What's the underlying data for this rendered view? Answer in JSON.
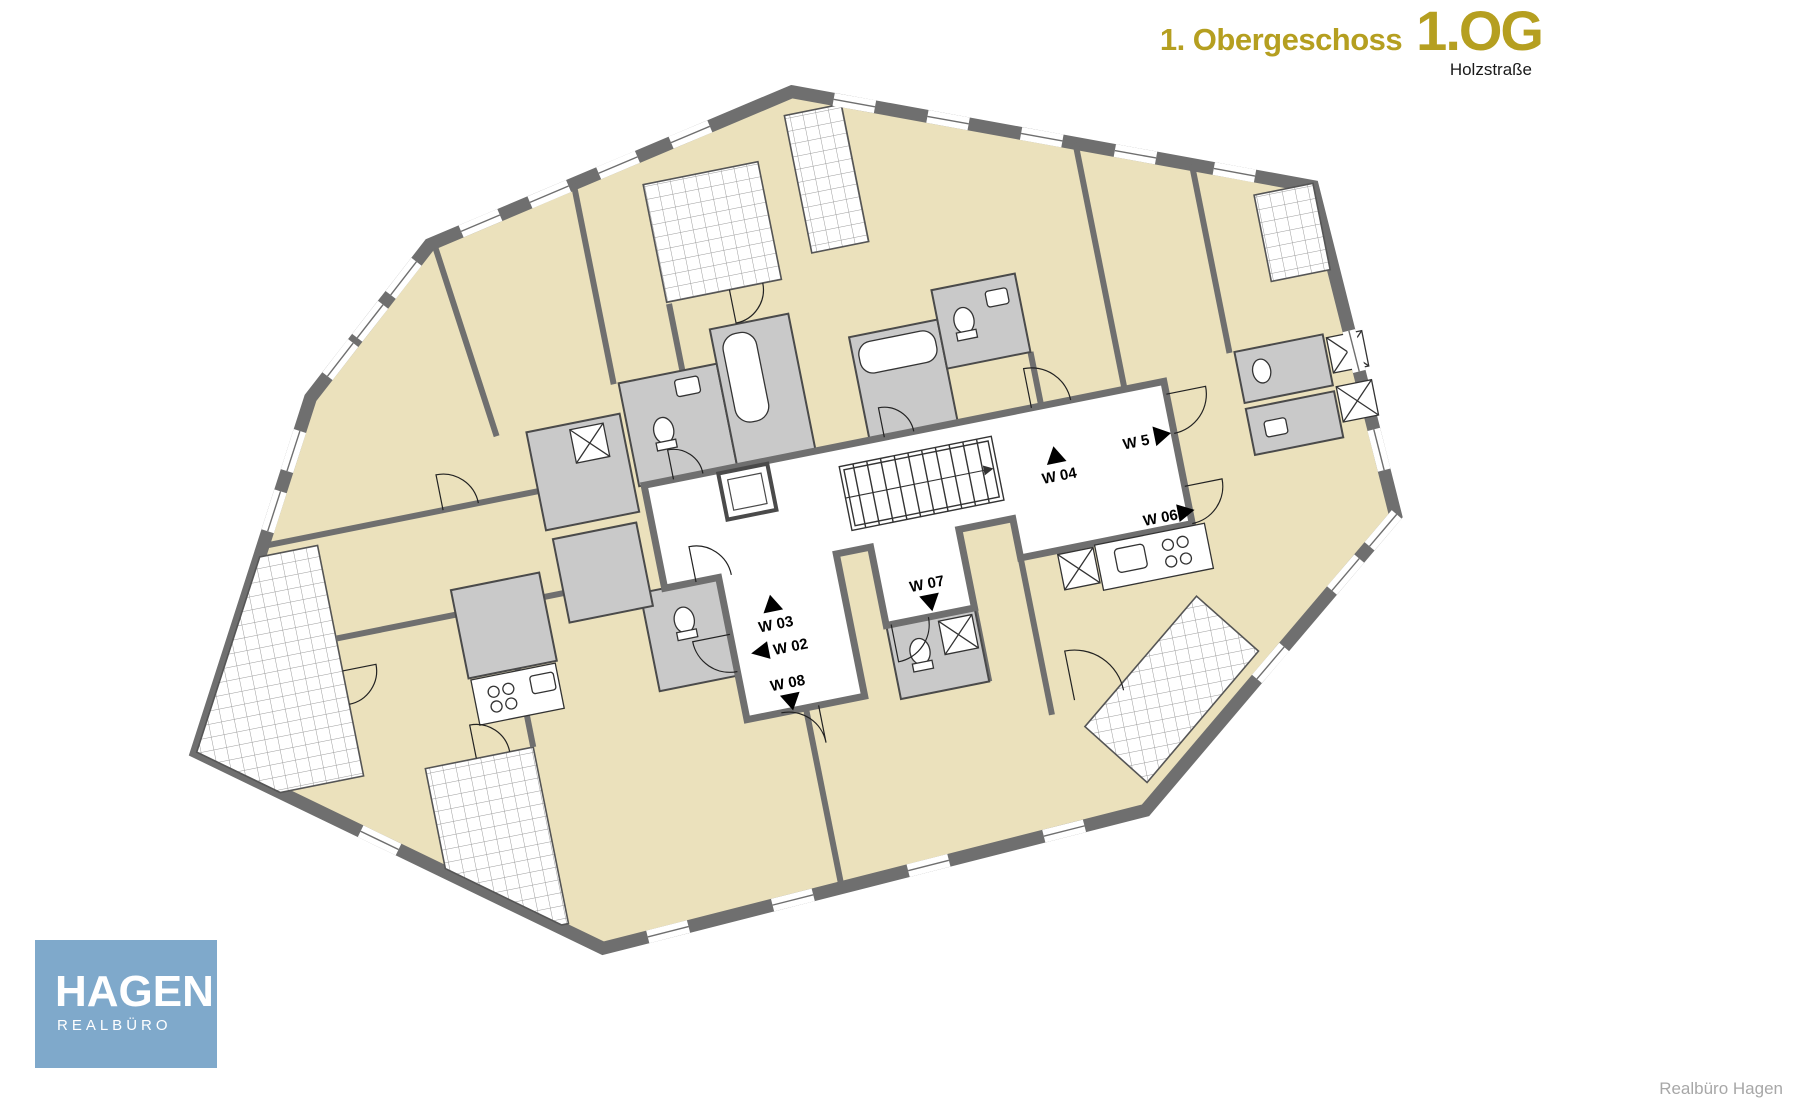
{
  "header": {
    "floor_name": "1. Obergeschoss",
    "floor_code": "1.OG",
    "street": "Holzstraße"
  },
  "plan": {
    "apartments": [
      {
        "id": "W 03",
        "arrow": "up"
      },
      {
        "id": "W 02",
        "arrow": "left"
      },
      {
        "id": "W 08",
        "arrow": "down"
      },
      {
        "id": "W 07",
        "arrow": "down"
      },
      {
        "id": "W 04",
        "arrow": "up"
      },
      {
        "id": "W 5",
        "arrow": "right"
      },
      {
        "id": "W 06",
        "arrow": "right"
      }
    ],
    "colors": {
      "room_fill": "#EBE1BC",
      "wet_room_fill": "#C9C9C9",
      "wall": "#6F6F6F",
      "corridor_fill": "#FFFFFF",
      "accent_gold": "#B59F20",
      "logo_blue": "#7FA9CB"
    }
  },
  "logo": {
    "title": "HAGEN",
    "subtitle": "REALBÜRO"
  },
  "watermark": "Realbüro Hagen"
}
